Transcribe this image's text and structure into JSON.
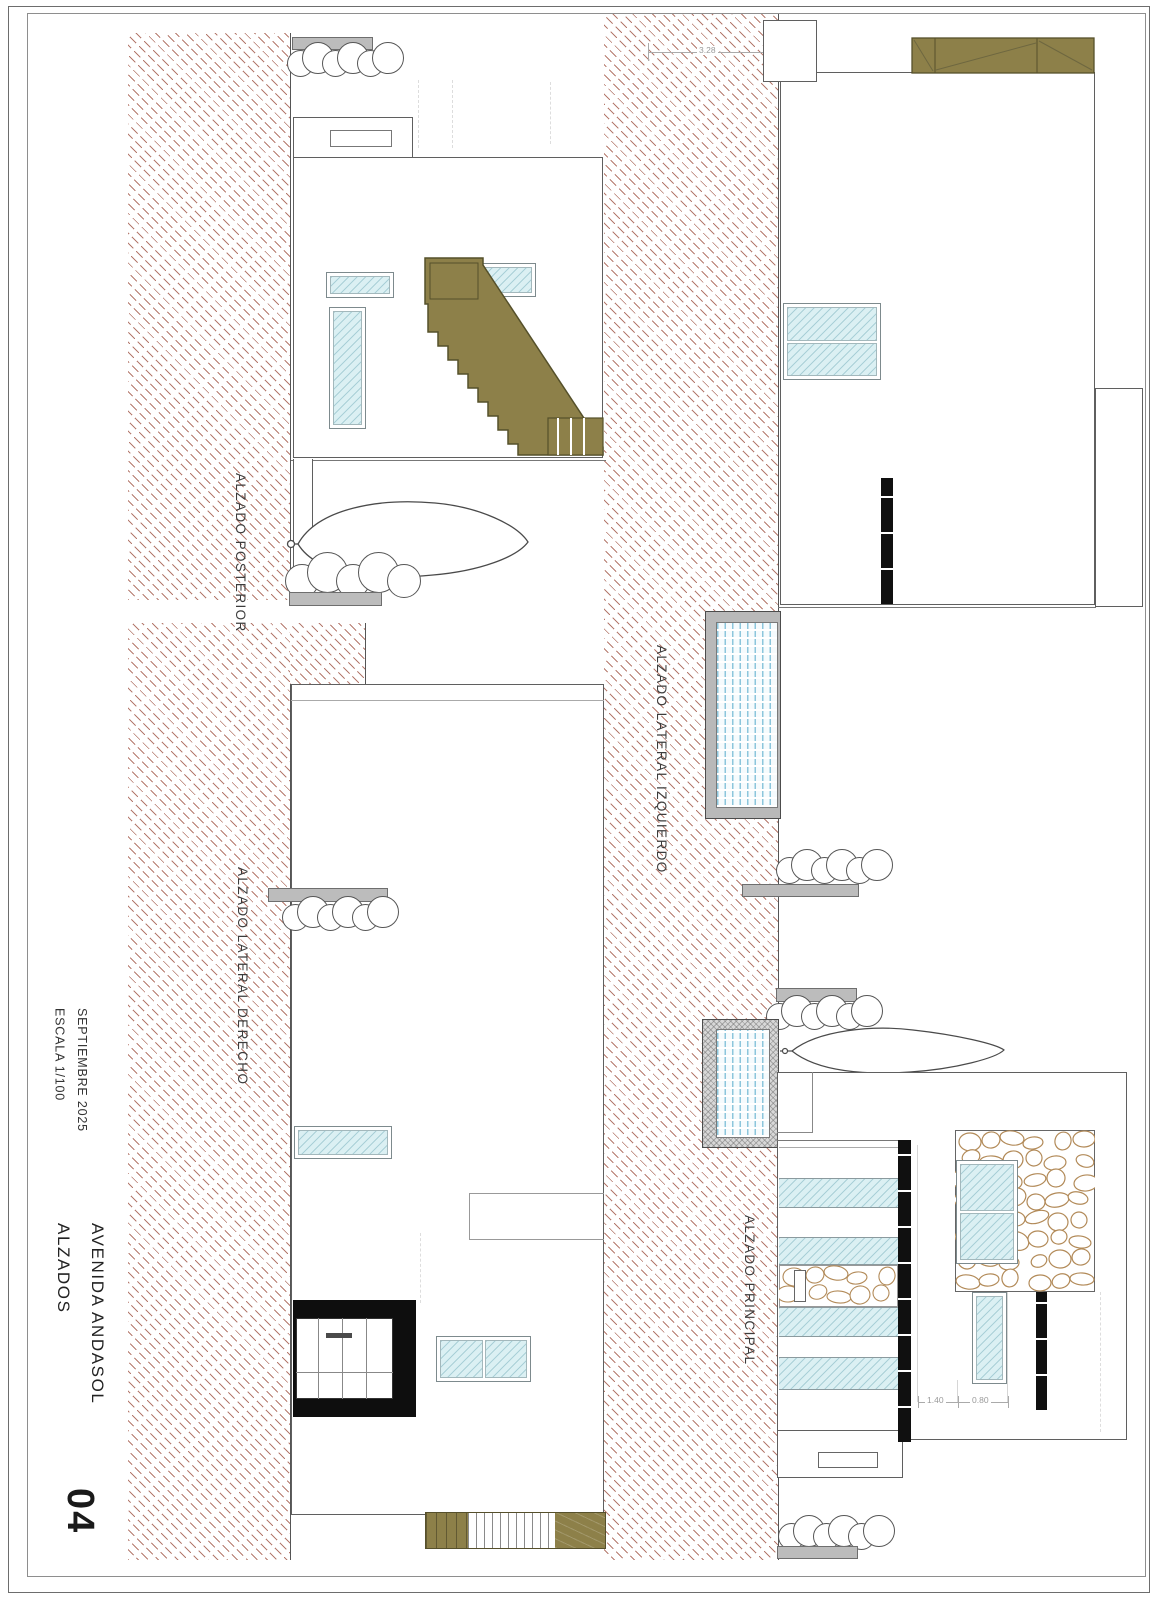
{
  "sheet": {
    "project": "AVENIDA ANDASOL",
    "title": "ALZADOS",
    "date": "SEPTIEMBRE 2025",
    "scale": "ESCALA 1/100",
    "number": "04"
  },
  "elevations": {
    "posterior": "ALZADO POSTERIOR",
    "lateral_izquierdo": "ALZADO LATERAL IZQUIERDO",
    "lateral_derecho": "ALZADO LATERAL DERECHO",
    "principal": "ALZADO PRINCIPAL"
  },
  "dimensions": {
    "roof_offset": "3.28",
    "front_left": "1.40",
    "front_right": "0.80"
  },
  "palette": {
    "hatch_line": "#a86354",
    "wood_olive": "#8d8049",
    "glass_cyan": "#dbf0f3",
    "frame_gray": "#bcbcbc",
    "pillar_black": "#101010",
    "stone_outline": "#b28a58"
  }
}
